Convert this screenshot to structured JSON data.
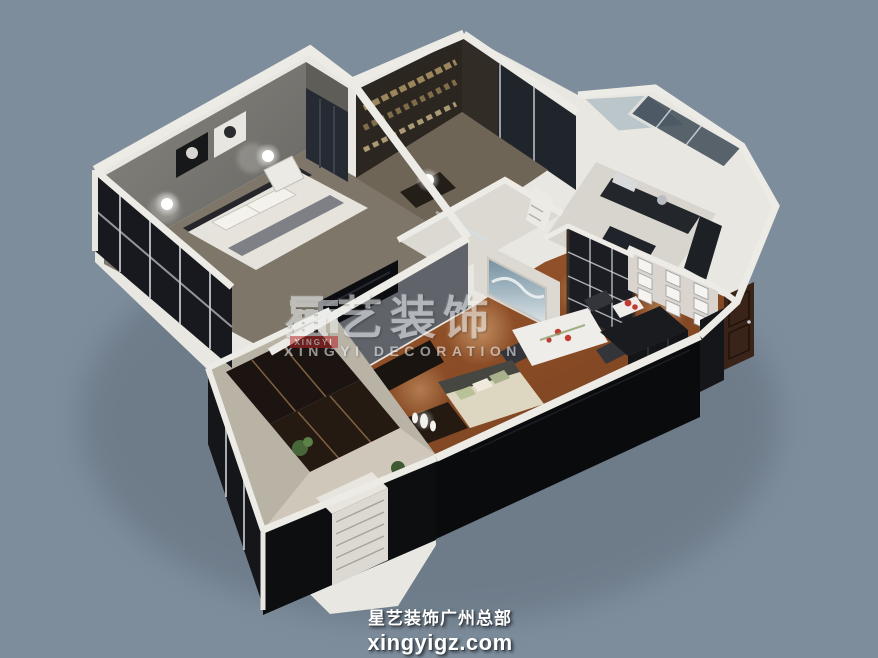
{
  "scene": {
    "type": "3d-isometric-apartment-floorplan-render",
    "background_color": "#7e8d9c"
  },
  "colors": {
    "wall_white": "#edebe5",
    "wood_floor": "#8f5128",
    "south_wall_black": "#0a0b0d",
    "watermark_red": "#b5282b"
  },
  "watermark": {
    "logo": "colonnade-house-icon",
    "logo_label": "XINGYI",
    "title": "星艺装饰",
    "subtitle": "XINGYI DECORATION"
  },
  "footer": {
    "line1": "星艺装饰广州总部",
    "line2": "xingyigz.com"
  }
}
